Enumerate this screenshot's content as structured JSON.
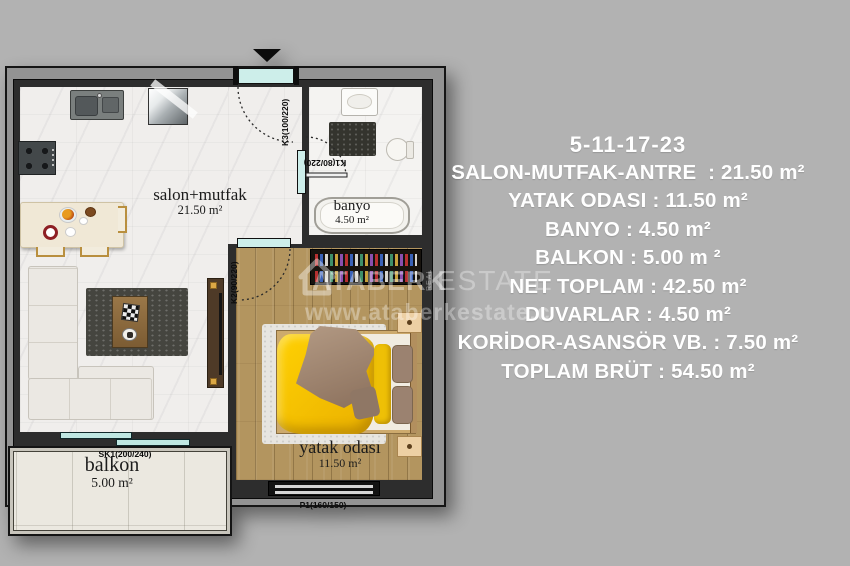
{
  "page": {
    "background": "#b2b2b2"
  },
  "plan": {
    "rooms": {
      "salon": {
        "name": "salon+mutfak",
        "area": "21.50 m²"
      },
      "banyo": {
        "name": "banyo",
        "area": "4.50 m²"
      },
      "yatak": {
        "name": "yatak odası",
        "area": "11.50 m²"
      },
      "balkon": {
        "name": "balkon",
        "area": "5.00 m²"
      }
    },
    "doors": {
      "entry": "K3(100/220)",
      "bath": "K1(80/220)",
      "bedroom": "K2(90/220)",
      "balcony_slider": "SK1(200/240)",
      "bedroom_window": "P1(160/150)"
    }
  },
  "specs": {
    "title": "5-11-17-23",
    "lines": [
      "SALON-MUTFAK-ANTRE  : 21.50 m²",
      "YATAK ODASI : 11.50 m²",
      "BANYO : 4.50 m²",
      "BALKON : 5.00 m ²",
      "NET TOPLAM : 42.50 m²",
      "DUVARLAR : 4.50 m²",
      "KORİDOR-ASANSÖR VB. : 7.50 m²",
      "TOPLAM BRÜT : 54.50 m²"
    ]
  },
  "watermark": {
    "brand": "ATABERK",
    "real": "REAL",
    "estate": "ESTATE",
    "url": "www.ataberkestate.c"
  },
  "colors": {
    "accent_glass": "#cdeeea",
    "wall_dark": "#2d2d2d",
    "bed_yellow": "#eab000"
  }
}
